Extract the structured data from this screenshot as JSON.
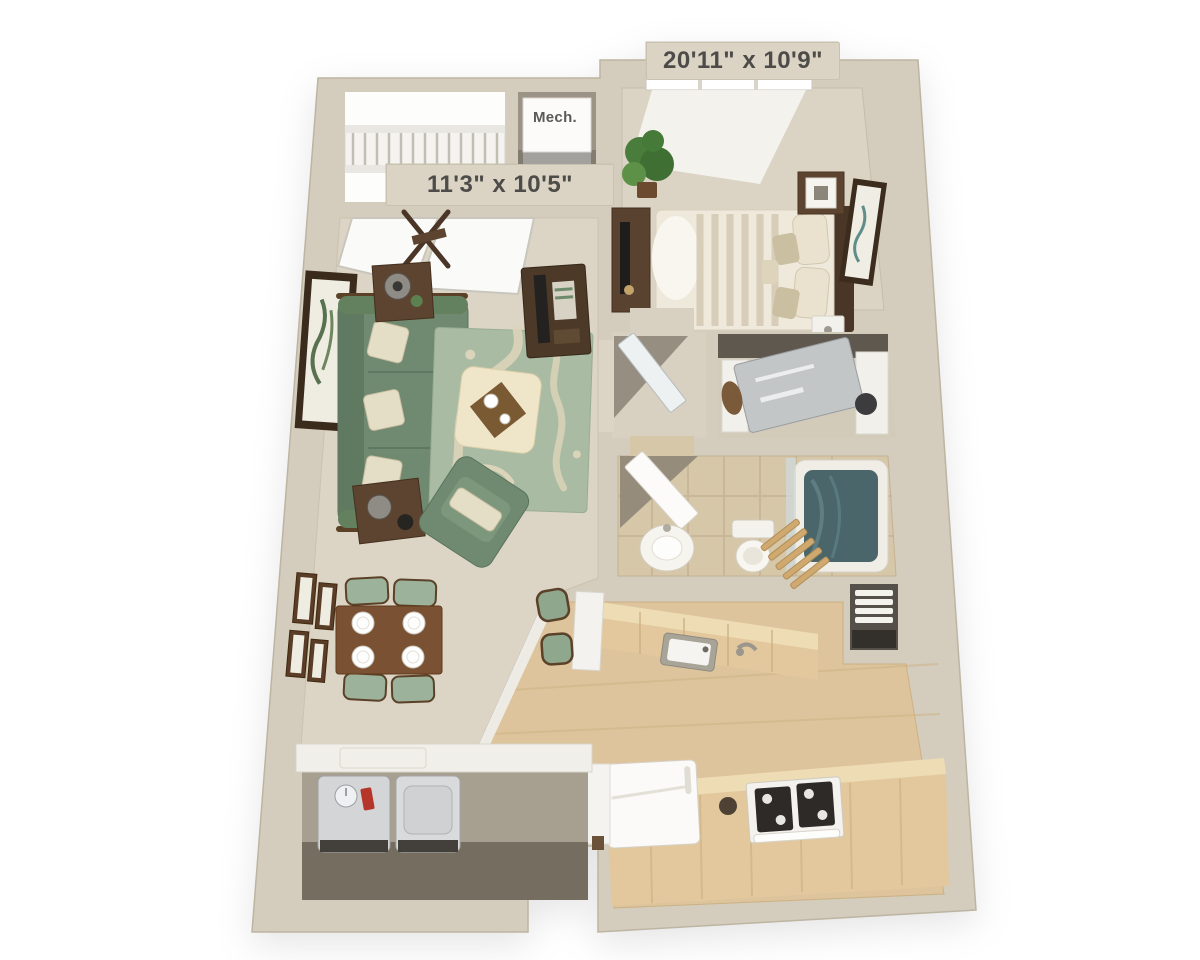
{
  "labels": {
    "living_room_dimensions": "11'3\" x 10'5\"",
    "bedroom_dimensions": "20'11\" x 10'9\"",
    "mechanical_closet": "Mech."
  },
  "colors": {
    "background": "#ffffff",
    "walls": "#d4ccbc",
    "carpet": "#dcd5c5",
    "wood_floor": "#ddc49c",
    "bathroom_tile": "#d6c7a9",
    "counter_wood": "#e2c89c",
    "sofa_green": "#6f8a70",
    "rug_sage": "#a9bba2",
    "dark_wood": "#5a4230",
    "tub_teal": "#4a666a",
    "label_text": "#4e4c49",
    "label_plate": "#dbd4c5"
  }
}
